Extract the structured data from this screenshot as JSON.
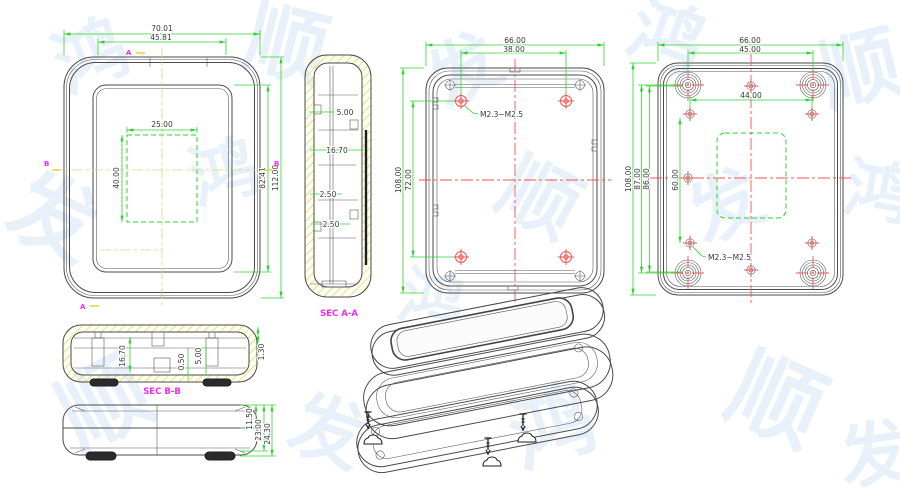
{
  "watermark": {
    "chars": [
      "鸿",
      "顺",
      "发"
    ],
    "color": "#d7e6f5"
  },
  "colors": {
    "dimension_green": "#2fd32f",
    "centerline_red": "#f25454",
    "section_magenta": "#f02bf0",
    "hatch_yellow": "#e3e32e",
    "outline_gray": "#4a4a4a"
  },
  "front_view": {
    "dim_overall_width": "70.01",
    "dim_inner_width": "45.81",
    "dim_window_width": "25.00",
    "dim_window_height": "40.00",
    "dim_inner_height": "82.41",
    "dim_overall_height": "112.00",
    "marker_a": "A",
    "marker_b": "B"
  },
  "section_aa": {
    "label": "SEC A-A",
    "dim_1": "5.00",
    "dim_2": "16.70",
    "dim_3": "2.50",
    "dim_4": "2.50"
  },
  "inner_back_view": {
    "dim_overall_width": "66.00",
    "dim_boss_width": "38.00",
    "dim_overall_height": "108.00",
    "dim_boss_height": "72.00",
    "thread_note": "M2.3~M2.5"
  },
  "outer_back_view": {
    "dim_overall_width": "66.00",
    "dim_foot_width": "45.00",
    "dim_hole_width": "44.00",
    "dim_hole_height": "60.00",
    "dim_overall_height": "108.00",
    "dim_foot_height": "87.00",
    "dim_inner_height": "86.00",
    "thread_note": "M2.3~M2.5"
  },
  "section_bb": {
    "label": "SEC B-B",
    "dim_1": "16.70",
    "dim_2": "0.50",
    "dim_3": "5.00",
    "dim_4": "1.30"
  },
  "side_view": {
    "dim_1": "11.50",
    "dim_2": "23.00",
    "dim_3": "24.30"
  }
}
